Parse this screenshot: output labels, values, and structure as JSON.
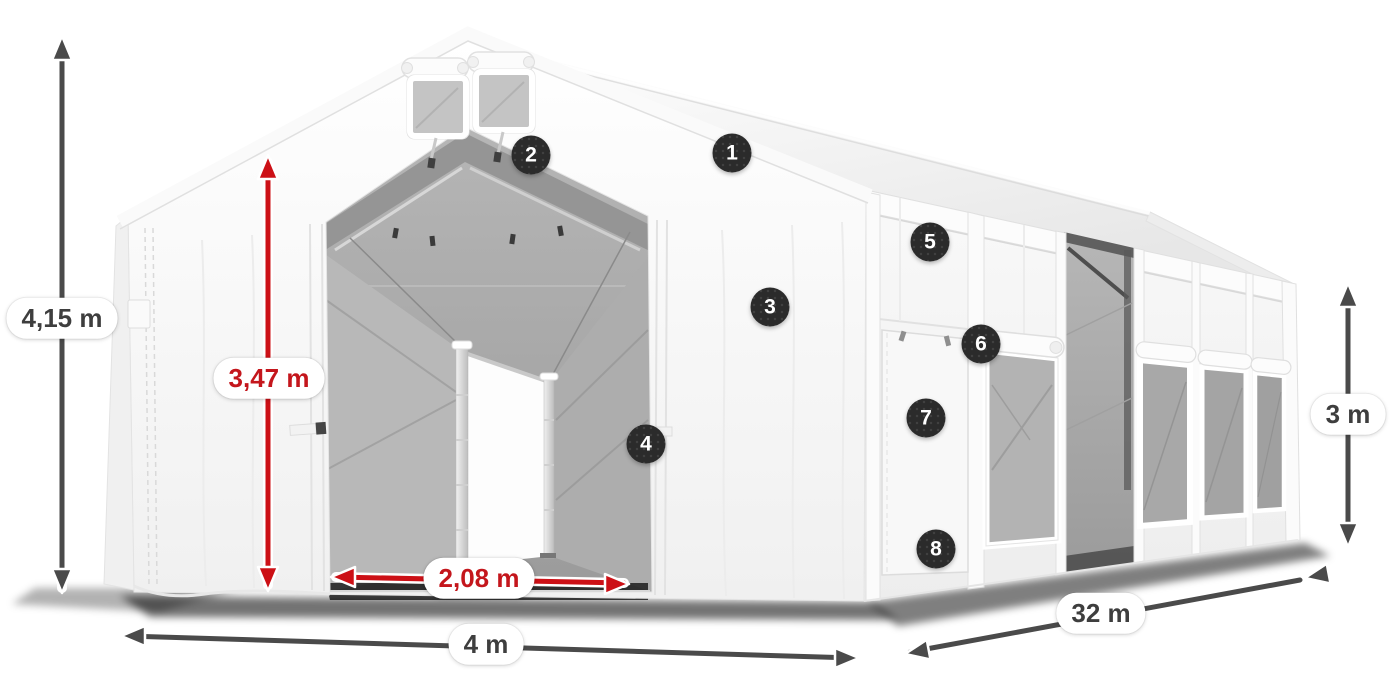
{
  "illustration": {
    "subject": "storage-tent-dimension-diagram",
    "dimensions": {
      "total_height": "4,15 m",
      "entrance_height": "3,47 m",
      "entrance_width": "2,08 m",
      "width": "4 m",
      "length": "32 m",
      "side_height": "3 m"
    },
    "callouts": [
      "1",
      "2",
      "3",
      "4",
      "5",
      "6",
      "7",
      "8"
    ],
    "colors": {
      "dimension_primary": "#4a4a4a",
      "dimension_accent": "#c9141a",
      "label_background": "#ffffff",
      "label_text": "#3e3e3e",
      "badge_background": "#2b2b2b",
      "badge_text": "#ffffff"
    }
  }
}
